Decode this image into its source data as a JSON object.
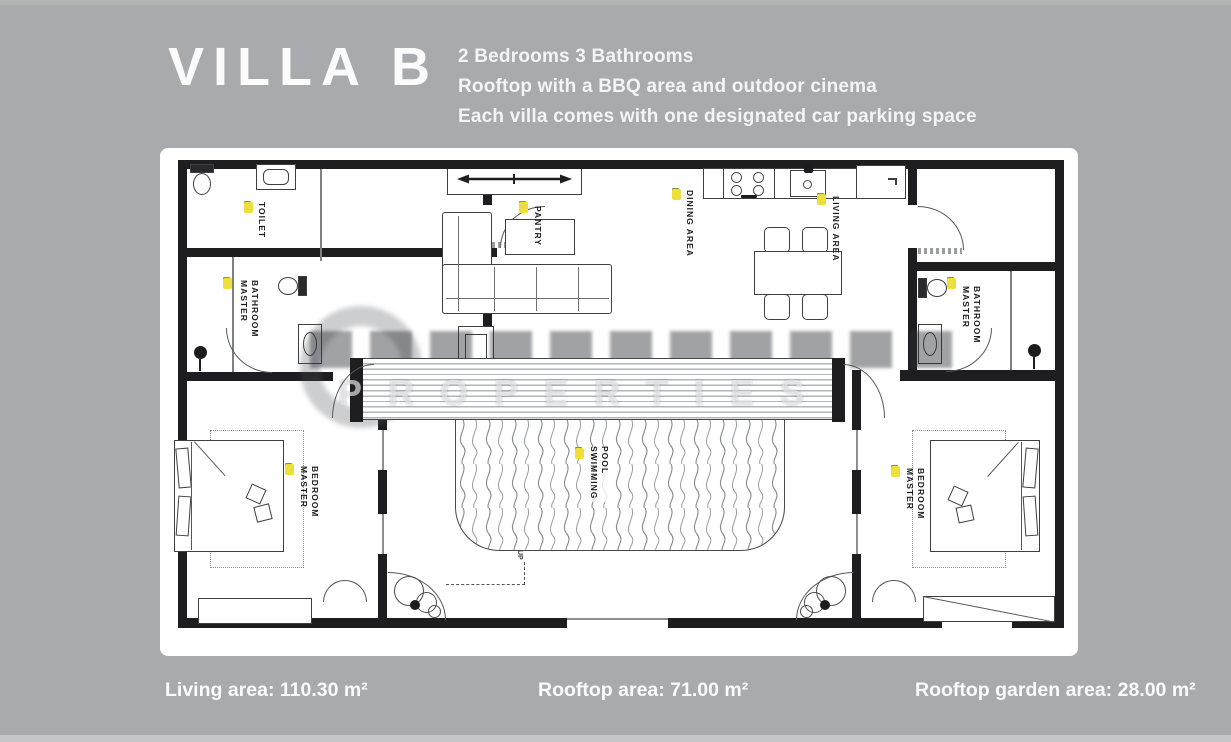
{
  "colors": {
    "background": "#a7abad",
    "panel": "#ffffff",
    "wall": "#1e1e20",
    "marker_yellow": "#efdf3b",
    "text_white": "#fbfbfb"
  },
  "header": {
    "title": "VILLA B",
    "features": [
      "2 Bedrooms 3 Bathrooms",
      "Rooftop with a BBQ area and outdoor cinema",
      "Each villa comes with one designated car parking space"
    ]
  },
  "stats": [
    "Living area: 110.30 m²",
    "Rooftop area: 71.00 m²",
    "Rooftop garden area: 28.00 m²"
  ],
  "floorplan": {
    "watermark": "PROPERTIES",
    "up_label": "UP",
    "rooms": [
      {
        "id": "toilet",
        "label": "TOILET"
      },
      {
        "id": "master-bathroom-left",
        "label": "MASTER BATHROOM"
      },
      {
        "id": "pantry",
        "label": "PANTRY"
      },
      {
        "id": "dining-area",
        "label": "DINING AREA"
      },
      {
        "id": "living-area",
        "label": "LIVING AREA"
      },
      {
        "id": "master-bathroom-right",
        "label": "MASTER BATHROOM"
      },
      {
        "id": "swimming-pool",
        "label": "SWIMMING POOL"
      },
      {
        "id": "master-bedroom-left",
        "label": "MASTER BEDROOM"
      },
      {
        "id": "master-bedroom-right",
        "label": "MASTER BEDROOM"
      }
    ]
  }
}
